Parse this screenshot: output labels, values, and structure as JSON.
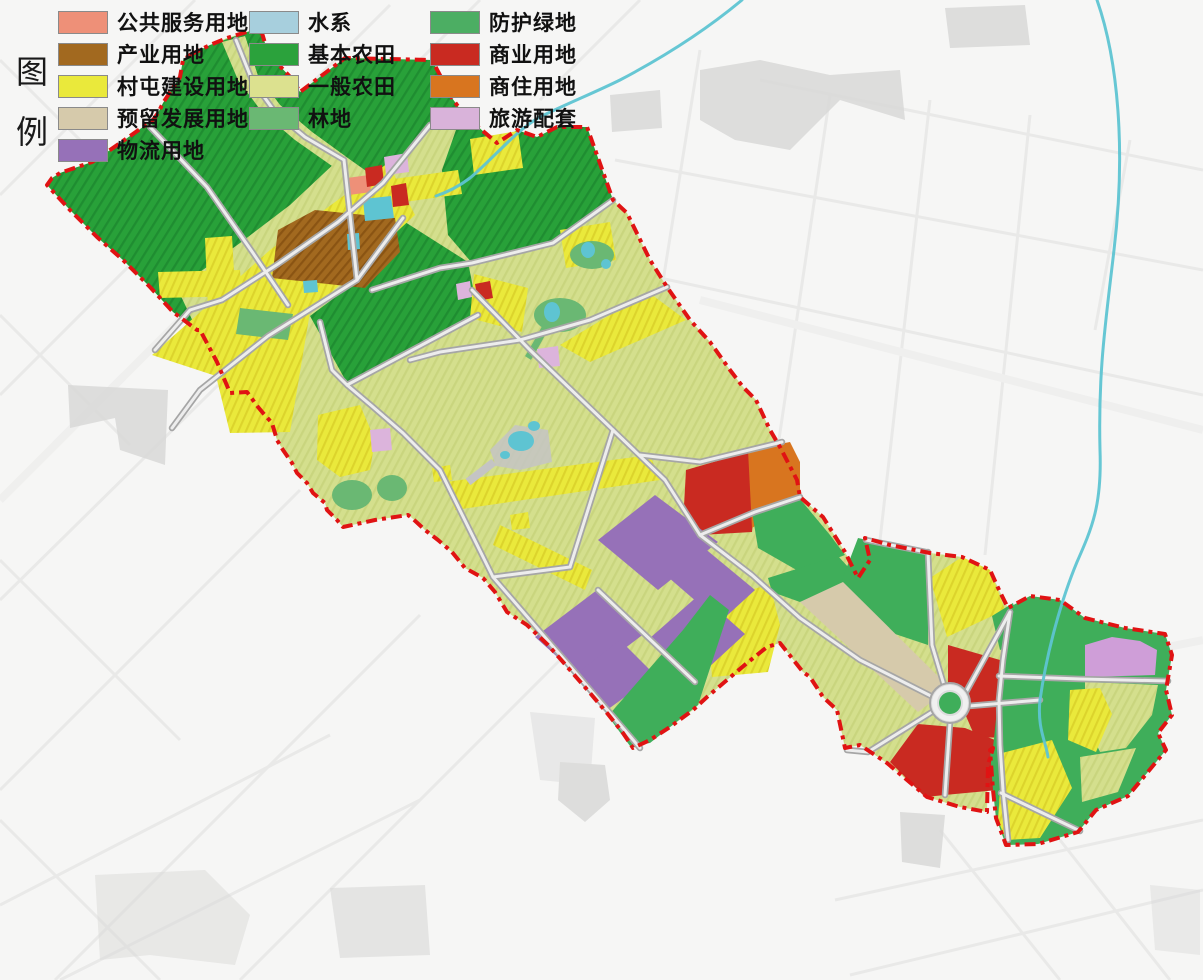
{
  "legend": {
    "title": "图\n例",
    "columns": [
      {
        "items": [
          {
            "label": "公共服务用地",
            "color": "#ee9078"
          },
          {
            "label": "产业用地",
            "color": "#a2691f"
          },
          {
            "label": "村屯建设用地",
            "color": "#eae93b"
          },
          {
            "label": "预留发展用地",
            "color": "#d6caab"
          },
          {
            "label": "物流用地",
            "color": "#9671b8"
          }
        ]
      },
      {
        "items": [
          {
            "label": "水系",
            "color": "#a7cfdd"
          },
          {
            "label": "基本农田",
            "color": "#2ba23c"
          },
          {
            "label": "一般农田",
            "color": "#dce18f"
          },
          {
            "label": "林地",
            "color": "#6ab873"
          }
        ]
      },
      {
        "items": [
          {
            "label": "防护绿地",
            "color": "#4cae63"
          },
          {
            "label": "商业用地",
            "color": "#c92a21"
          },
          {
            "label": "商住用地",
            "color": "#d8751f"
          },
          {
            "label": "旅游配套",
            "color": "#d9b3da"
          }
        ]
      }
    ]
  },
  "map": {
    "boundary_color": "#e01313",
    "river_color": "#5ec4d2",
    "road_color": "#a6a6a6",
    "basemap_color": "#e9e9e8"
  }
}
